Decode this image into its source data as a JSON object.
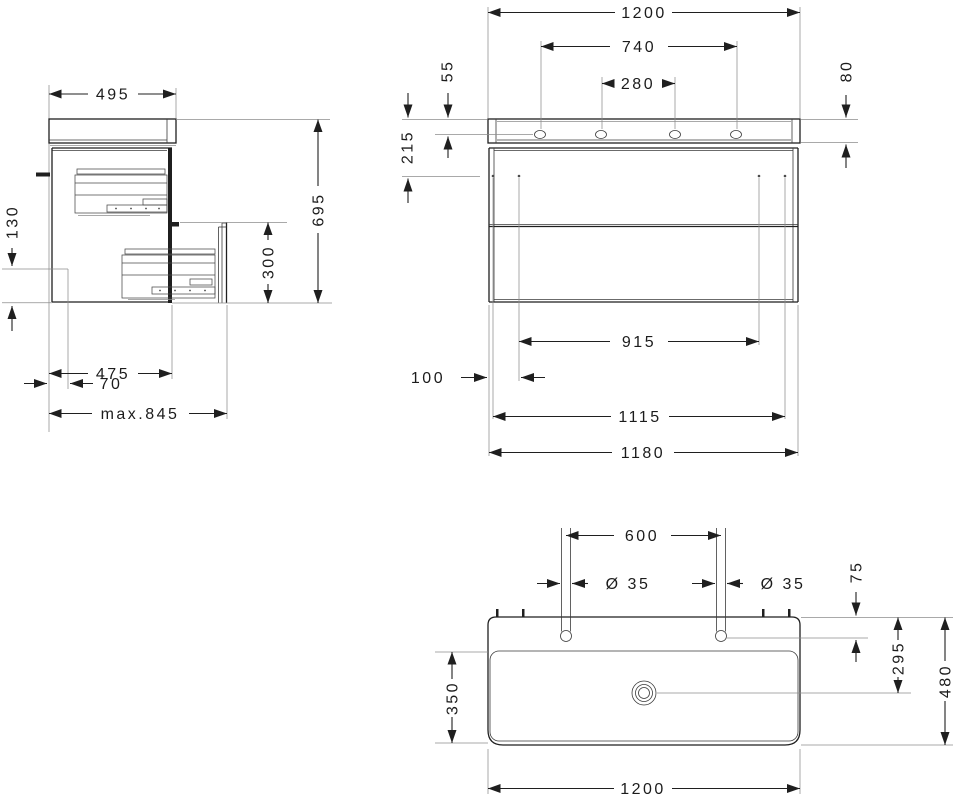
{
  "page": {
    "background": "#ffffff",
    "line_color": "#1f1f1f"
  },
  "drawing": {
    "side_view": {
      "dims": {
        "washbasin_depth": "495",
        "siphon_clearance_height": "130",
        "total_height": "695",
        "drawer_front_height": "300",
        "wall_offset": "70",
        "cabinet_depth": "475",
        "max_pullout": "max.845"
      }
    },
    "front_view": {
      "dims": {
        "basin_width": "1200",
        "outer_taphole_span": "740",
        "inner_taphole_span": "280",
        "taphole_drop": "55",
        "basin_front_height": "80",
        "mounting_drop": "215",
        "runner_span": "915",
        "side_offset": "100",
        "inner_span": "1115",
        "cabinet_width": "1180"
      }
    },
    "top_view": {
      "dims": {
        "taphole_distance": "600",
        "taphole_dia_left": "Ø 35",
        "taphole_dia_right": "Ø 35",
        "taphole_edge_offset": "75",
        "drain_offset": "295",
        "basin_total_depth": "480",
        "bowl_depth": "350",
        "basin_width": "1200"
      }
    }
  }
}
